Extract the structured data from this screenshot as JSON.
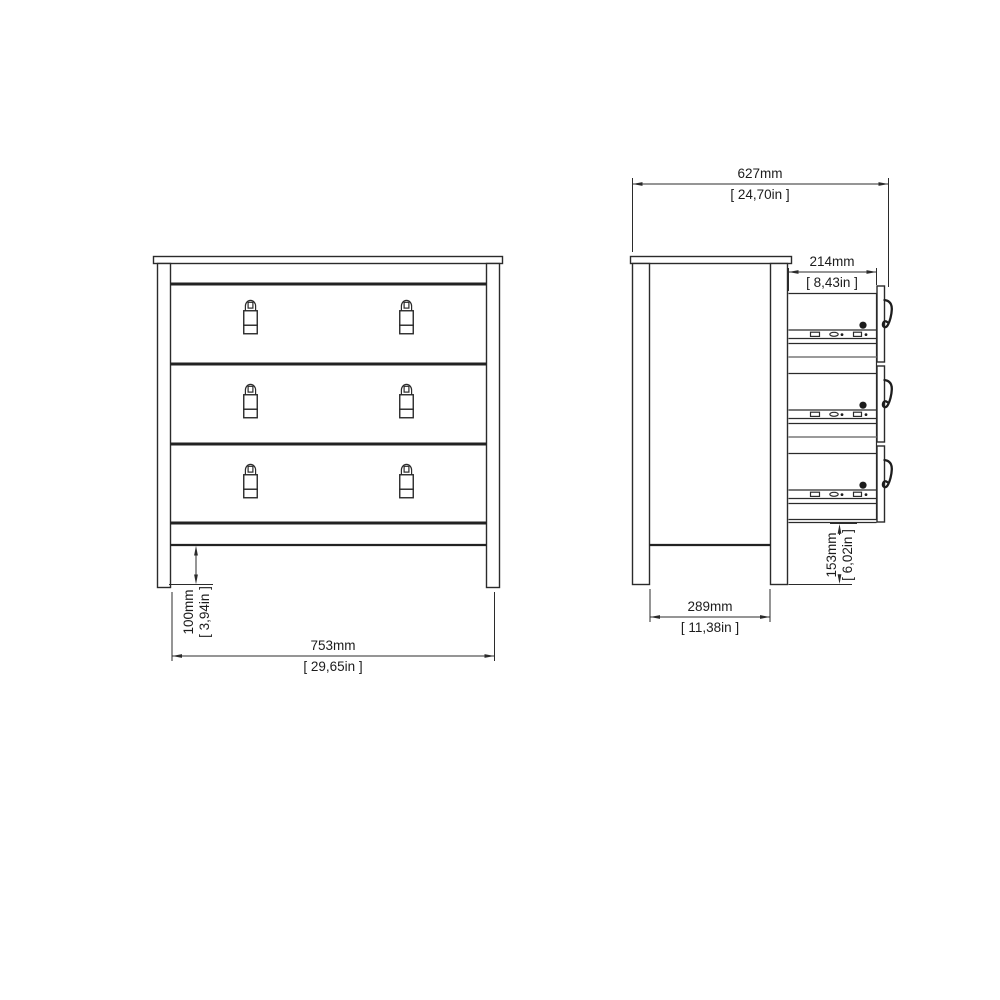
{
  "style": {
    "background": "#ffffff",
    "line_color": "#2b2b2b",
    "separator_gray": "#9a9a9a"
  },
  "dimensions": {
    "front_width": {
      "mm": "753mm",
      "inches": "[ 29,65in ]"
    },
    "front_leg_height": {
      "mm": "100mm",
      "inches": "[ 3,94in ]"
    },
    "side_depth": {
      "mm": "627mm",
      "inches": "[ 24,70in ]"
    },
    "side_drawer_depth": {
      "mm": "214mm",
      "inches": "[ 8,43in ]"
    },
    "side_base_span": {
      "mm": "289mm",
      "inches": "[ 11,38in ]"
    },
    "side_leg_height": {
      "mm": "153mm",
      "inches": "[ 6,02in ]"
    }
  }
}
